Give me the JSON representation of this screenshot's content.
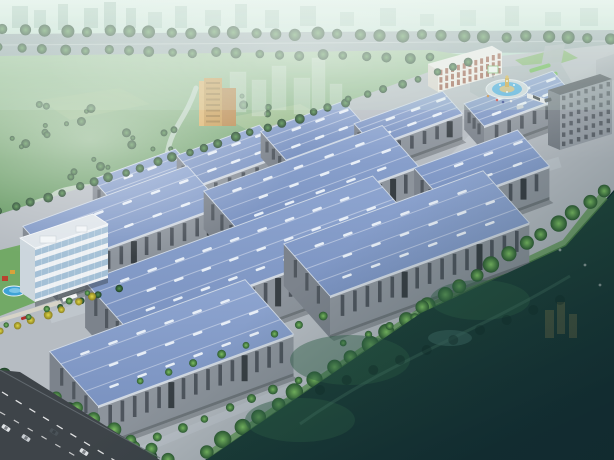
{
  "meta": {
    "alt": "aerial rendering of industrial park",
    "width": 614,
    "height": 460
  },
  "palette": {
    "sky_top": "#dcefe5",
    "sky_bottom": "#aed2c2",
    "city_block": "#7fa896",
    "road_top": "#93a2a6",
    "road_median": "#ccd6d8",
    "park_top": "#9ec39a",
    "park_bottom": "#649861",
    "field_patch1": "#a9c595",
    "field_patch2": "#9cbd8c",
    "lake": "#c3d4c6",
    "river": "#c2d6c8",
    "ground": "#b6bcc2",
    "inner_road": "#c2c8ce",
    "lawn_band": "#5d9a50",
    "roof_hi": "#8ea5d0",
    "roof_lo": "#7b93c1",
    "roof_edge": "#cfd9e6",
    "skylight": "#ecf2f9",
    "ridge": "rgba(255,255,255,0.38)",
    "wall_front": "#8d949c",
    "wall_side": "#7c838c",
    "wall_base": "#6b7278",
    "window_strip": "#454c54",
    "door": "#2f353b",
    "fascia": "#d8dee6",
    "shadow": "#30363c",
    "tree_dark_in": "#55924f",
    "tree_dark_out": "#1f4029",
    "tree_bright_in": "#7ec163",
    "tree_bright_out": "#2d5c33",
    "tree_yellow_in": "#e0d84a",
    "tree_yellow_out": "#8a7f1f",
    "office_frame": "#eef1f4",
    "office_glass": "#9fbdd4",
    "office_side": "#ccd6dd",
    "office_roof": "#dfe5ea",
    "red_bldg_face": "#f0ece6",
    "red_bldg_win": "#96513d",
    "red_bldg_side": "#d9d3cb",
    "red_bldg_roof": "#eceae6",
    "dorm_face": "#979ea6",
    "dorm_side": "#777e86",
    "dorm_roof": "#565c63",
    "dorm_win": "#4d545c",
    "tower_face": "#c79b52",
    "tower_side": "#dbb066",
    "tower_wing": "#b8874a",
    "ghost_bldg": "#dfe9e4",
    "plaza": "#aab3b8",
    "fountain_water": "#4fadde",
    "fountain_rim": "#ccd5da",
    "fountain_island": "#c9b878",
    "gold": "#c9a23b",
    "hedge1": "#6cb854",
    "hedge2": "#5da649",
    "entry_lawn": "#7ab061",
    "pool_water": "#3fa3d6",
    "pool_light": "#7cc6e8",
    "kiosk_red": "#b8432f",
    "kiosk_yellow": "#d8a23a",
    "garden_lawn": "#6aa65c",
    "path": "#d9d5c8",
    "red_car": "#b03028",
    "field_dark1": "#2a5a41",
    "field_dark2": "#132e33",
    "field_ghost": "#2f6247",
    "field_pond": "#3d6b62",
    "field_road": "#4e7f6b",
    "field_tower": "#caa95a",
    "sw_road": "#3e4449",
    "sw_road_edge": "#6a7278",
    "lane_dash": "#ffffff",
    "car_white": "#dfe3e6",
    "car_silver": "#c8cdd2",
    "car_dark": "#4a5258",
    "haze_white": "#ffffff",
    "haze_dark": "#10282c",
    "haze_tint": "#cfe8da"
  },
  "iso": {
    "u": [
      0.94,
      -0.345
    ],
    "v": [
      -0.55,
      -0.62
    ]
  },
  "skyline": {
    "band_h": 36,
    "blocks": [
      [
        12,
        6,
        16,
        22,
        0.5
      ],
      [
        34,
        10,
        12,
        18,
        0.45
      ],
      [
        58,
        4,
        10,
        26,
        0.5
      ],
      [
        84,
        8,
        14,
        20,
        0.5
      ],
      [
        104,
        2,
        12,
        28,
        0.55
      ],
      [
        126,
        8,
        10,
        20,
        0.5
      ],
      [
        148,
        12,
        14,
        16,
        0.4
      ],
      [
        175,
        6,
        12,
        22,
        0.45
      ],
      [
        205,
        10,
        16,
        16,
        0.4
      ],
      [
        235,
        4,
        12,
        24,
        0.45
      ],
      [
        265,
        10,
        14,
        18,
        0.4
      ],
      [
        300,
        6,
        16,
        20,
        0.4
      ],
      [
        340,
        12,
        14,
        14,
        0.35
      ],
      [
        380,
        8,
        16,
        18,
        0.35
      ],
      [
        420,
        14,
        14,
        12,
        0.3
      ],
      [
        460,
        10,
        16,
        16,
        0.3
      ],
      [
        505,
        6,
        14,
        20,
        0.32
      ],
      [
        545,
        12,
        16,
        14,
        0.3
      ],
      [
        580,
        8,
        18,
        18,
        0.32
      ]
    ]
  },
  "boulevard": {
    "road": [
      [
        0,
        34
      ],
      [
        614,
        30
      ],
      [
        614,
        52
      ],
      [
        0,
        56
      ]
    ],
    "median": {
      "a": [
        0,
        45
      ],
      "b": [
        614,
        41
      ]
    }
  },
  "park": {
    "base": [
      [
        0,
        56
      ],
      [
        430,
        50
      ],
      [
        470,
        56
      ],
      [
        340,
        108
      ],
      [
        0,
        214
      ]
    ],
    "fields": [
      {
        "pts": [
          [
            250,
            150
          ],
          [
            330,
            135
          ],
          [
            360,
            155
          ],
          [
            300,
            175
          ]
        ],
        "fill": "field_patch1",
        "o": 0.8
      },
      {
        "pts": [
          [
            150,
            190
          ],
          [
            230,
            175
          ],
          [
            262,
            196
          ],
          [
            190,
            215
          ]
        ],
        "fill": "field_patch2",
        "o": 0.8
      },
      {
        "pts": [
          [
            226,
            118
          ],
          [
            300,
            104
          ],
          [
            330,
            120
          ],
          [
            262,
            138
          ]
        ],
        "fill": "field_patch1",
        "o": 0.6
      },
      {
        "pts": [
          [
            40,
            100
          ],
          [
            120,
            88
          ],
          [
            150,
            104
          ],
          [
            70,
            120
          ]
        ],
        "fill": "field_patch2",
        "o": 0.5
      }
    ],
    "lake": [
      {
        "cx": 95,
        "cy": 197,
        "rx": 45,
        "ry": 13
      },
      {
        "cx": 150,
        "cy": 186,
        "rx": 30,
        "ry": 10
      },
      {
        "cx": 52,
        "cy": 206,
        "rx": 22,
        "ry": 9
      }
    ],
    "river_d": "M196,88 C186,118 172,128 168,150 C165,168 150,178 142,196",
    "clusters": [
      [
        65,
        115,
        7,
        26
      ],
      [
        150,
        140,
        7,
        24
      ],
      [
        250,
        105,
        5,
        20
      ],
      [
        215,
        170,
        6,
        24
      ],
      [
        90,
        168,
        5,
        20
      ],
      [
        300,
        150,
        4,
        16
      ],
      [
        30,
        140,
        5,
        18
      ]
    ],
    "ghosts": [
      [
        230,
        72,
        16,
        40
      ],
      [
        252,
        80,
        14,
        36
      ],
      [
        272,
        66,
        14,
        44
      ],
      [
        294,
        78,
        16,
        36
      ],
      [
        312,
        58,
        13,
        52
      ],
      [
        330,
        84,
        12,
        30
      ]
    ],
    "tower": {
      "front": [
        204,
        78,
        18,
        48
      ],
      "wing": [
        222,
        88,
        14,
        38
      ],
      "side_w": 5
    }
  },
  "site": {
    "ground": [
      [
        0,
        214
      ],
      [
        345,
        102
      ],
      [
        462,
        60
      ],
      [
        614,
        44
      ],
      [
        614,
        190
      ],
      [
        565,
        245
      ],
      [
        420,
        312
      ],
      [
        205,
        460
      ],
      [
        0,
        460
      ]
    ],
    "roads": [
      {
        "d": "M40,252 L470,112",
        "w": 9,
        "o": 0.8
      },
      {
        "d": "M50,318 L560,162",
        "w": 11,
        "o": 0.8
      },
      {
        "d": "M508,102 L330,290",
        "w": 11,
        "o": 0.75
      },
      {
        "d": "M112,462 L330,372",
        "w": 8,
        "o": 0.6
      }
    ],
    "lawn_d": "M604,196 L566,244 L422,312 L206,458"
  },
  "warehouses": [
    {
      "id": "s1",
      "p": [
        118,
        208
      ],
      "len": 88,
      "dep": 46,
      "wall": 26
    },
    {
      "id": "s2",
      "p": [
        202,
        184
      ],
      "len": 88,
      "dep": 46,
      "wall": 26
    },
    {
      "id": "s3",
      "p": [
        286,
        160
      ],
      "len": 88,
      "dep": 46,
      "wall": 26
    },
    {
      "id": "s4",
      "p": [
        374,
        146
      ],
      "len": 94,
      "dep": 36,
      "wall": 26
    },
    {
      "id": "s5",
      "p": [
        484,
        126
      ],
      "len": 94,
      "dep": 36,
      "wall": 26
    },
    {
      "id": "m1",
      "p": [
        58,
        266
      ],
      "len": 175,
      "dep": 64,
      "wall": 36
    },
    {
      "id": "m2",
      "p": [
        240,
        232
      ],
      "len": 190,
      "dep": 66,
      "wall": 38
    },
    {
      "id": "m3",
      "p": [
        446,
        204
      ],
      "len": 110,
      "dep": 58,
      "wall": 34
    },
    {
      "id": "f2",
      "p": [
        128,
        330
      ],
      "len": 306,
      "dep": 78,
      "wall": 46
    },
    {
      "id": "f3",
      "p": [
        330,
        296
      ],
      "len": 212,
      "dep": 84,
      "wall": 42
    },
    {
      "id": "f1",
      "p": [
        98,
        406
      ],
      "len": 208,
      "dep": 88,
      "wall": 42
    }
  ],
  "entry": {
    "plaza": [
      [
        470,
        70
      ],
      [
        560,
        62
      ],
      [
        580,
        96
      ],
      [
        505,
        112
      ],
      [
        470,
        92
      ]
    ],
    "access": [
      [
        545,
        46
      ],
      [
        565,
        44
      ],
      [
        560,
        70
      ],
      [
        540,
        72
      ]
    ],
    "red_building": {
      "front": [
        [
          438,
          70
        ],
        [
          502,
          52
        ],
        [
          502,
          74
        ],
        [
          438,
          92
        ]
      ],
      "side": [
        [
          428,
          64
        ],
        [
          438,
          70
        ],
        [
          438,
          92
        ],
        [
          428,
          86
        ]
      ],
      "roof": [
        [
          428,
          64
        ],
        [
          438,
          70
        ],
        [
          502,
          52
        ],
        [
          492,
          46
        ]
      ],
      "win_rows": 3,
      "win_cols": 11
    },
    "dorm": {
      "back_block": [
        [
          596,
          60
        ],
        [
          614,
          54
        ],
        [
          614,
          80
        ],
        [
          596,
          86
        ]
      ],
      "front": [
        [
          560,
          95
        ],
        [
          612,
          79
        ],
        [
          612,
          134
        ],
        [
          560,
          150
        ]
      ],
      "side": [
        [
          548,
          90
        ],
        [
          560,
          95
        ],
        [
          560,
          150
        ],
        [
          548,
          145
        ]
      ],
      "roof": [
        [
          548,
          90
        ],
        [
          560,
          95
        ],
        [
          612,
          79
        ],
        [
          600,
          74
        ]
      ],
      "win_rows": 6,
      "win_cols": 7
    },
    "gate": {
      "wall": [
        [
          527,
          93
        ],
        [
          546,
          99
        ],
        [
          546,
          104
        ],
        [
          527,
          98
        ]
      ],
      "bar": [
        [
          533,
          95
        ],
        [
          540,
          98
        ],
        [
          540,
          101
        ],
        [
          533,
          98
        ]
      ]
    },
    "billboard": {
      "x": 488,
      "y": 66,
      "w": 10,
      "h": 7
    },
    "hedges": [
      {
        "cx": 540,
        "cy": 68,
        "w": 22,
        "h": 4
      },
      {
        "cx": 548,
        "cy": 76,
        "w": 20,
        "h": 4
      }
    ],
    "lawn": [
      [
        515,
        60
      ],
      [
        560,
        48
      ],
      [
        578,
        58
      ],
      [
        532,
        72
      ]
    ],
    "fountain": {
      "cx": 507,
      "cy": 89,
      "rx_plaza": 21,
      "ry_plaza": 9.5,
      "rx_water": 15,
      "ry_water": 7,
      "rx_island": 7.5,
      "ry_island": 3.5,
      "jets": [
        [
          500,
          85
        ],
        [
          514,
          85
        ],
        [
          507,
          81
        ],
        [
          507,
          92
        ]
      ]
    },
    "people": [
      [
        497,
        100,
        "#c23434"
      ],
      [
        503,
        102,
        "#2b3a8c"
      ],
      [
        511,
        101,
        "#e8e8e8"
      ],
      [
        488,
        96,
        "#c87f2a"
      ]
    ],
    "cars": [
      [
        520,
        107,
        -15,
        "car_silver"
      ],
      [
        548,
        100,
        -15,
        "car_dark"
      ]
    ]
  },
  "office": {
    "front": [
      [
        35,
        302
      ],
      [
        108,
        278
      ],
      [
        108,
        224
      ],
      [
        35,
        248
      ]
    ],
    "side": [
      [
        20,
        292
      ],
      [
        35,
        302
      ],
      [
        35,
        248
      ],
      [
        20,
        238
      ]
    ],
    "roof": [
      [
        20,
        238
      ],
      [
        35,
        248
      ],
      [
        108,
        224
      ],
      [
        93,
        214
      ]
    ],
    "floors": 5,
    "boxes": [
      [
        40,
        236,
        16,
        7
      ],
      [
        76,
        226,
        11,
        6
      ]
    ],
    "canopy": [
      [
        62,
        298,
        15,
        4
      ]
    ],
    "shadow": [
      [
        35,
        302
      ],
      [
        108,
        278
      ],
      [
        108,
        283
      ],
      [
        35,
        307
      ]
    ]
  },
  "garden": {
    "lawn": [
      [
        0,
        250
      ],
      [
        32,
        242
      ],
      [
        62,
        292
      ],
      [
        0,
        316
      ]
    ],
    "path": [
      [
        0,
        318
      ],
      [
        60,
        300
      ],
      [
        62,
        304
      ],
      [
        0,
        322
      ]
    ],
    "pool": {
      "cx": 14,
      "cy": 291,
      "rx": 11,
      "ry": 5
    },
    "kiosks": [
      {
        "x": 2,
        "y": 276,
        "w": 6,
        "h": 5,
        "fill": "kiosk_red"
      },
      {
        "x": 10,
        "y": 270,
        "w": 5,
        "h": 4,
        "fill": "kiosk_yellow"
      }
    ],
    "car": {
      "x": 24,
      "y": 318,
      "rot": -18
    }
  },
  "tree_rows": [
    {
      "a": [
        4,
        30
      ],
      "b": [
        610,
        38
      ],
      "n": 30,
      "r": 6,
      "g": "t1"
    },
    {
      "a": [
        0,
        48
      ],
      "b": [
        430,
        58
      ],
      "n": 21,
      "r": 5,
      "g": "t1"
    },
    {
      "a": [
        0,
        212
      ],
      "b": [
        345,
        103
      ],
      "n": 23,
      "r": 4.5,
      "g": "t1"
    },
    {
      "a": [
        350,
        100
      ],
      "b": [
        470,
        62
      ],
      "n": 8,
      "r": 4,
      "g": "t1"
    },
    {
      "a": [
        606,
        192
      ],
      "b": [
        428,
        306
      ],
      "n": 12,
      "r": 7.5,
      "g": "t2"
    },
    {
      "a": [
        424,
        308
      ],
      "b": [
        205,
        452
      ],
      "n": 13,
      "r": 8,
      "g": "t2"
    },
    {
      "a": [
        6,
        376
      ],
      "b": [
        150,
        458
      ],
      "n": 8,
      "r": 8.5,
      "g": "t1"
    },
    {
      "a": [
        58,
        398
      ],
      "b": [
        168,
        460
      ],
      "n": 7,
      "r": 6.5,
      "g": "t2"
    },
    {
      "a": [
        112,
        456
      ],
      "b": [
        298,
        380
      ],
      "n": 9,
      "r": 4.5,
      "g": "t2"
    },
    {
      "a": [
        345,
        344
      ],
      "b": [
        528,
        272
      ],
      "n": 9,
      "r": 4,
      "g": "t2"
    },
    {
      "a": [
        142,
        382
      ],
      "b": [
        325,
        316
      ],
      "n": 8,
      "r": 4,
      "g": "t2"
    },
    {
      "a": [
        62,
        308
      ],
      "b": [
        118,
        288
      ],
      "n": 4,
      "r": 3.5,
      "g": "t1"
    },
    {
      "a": [
        2,
        332
      ],
      "b": [
        92,
        297
      ],
      "n": 7,
      "r": 4,
      "g": "ty"
    },
    {
      "a": [
        8,
        326
      ],
      "b": [
        88,
        292
      ],
      "n": 5,
      "r": 3.2,
      "g": "t2"
    }
  ],
  "field": {
    "poly": [
      [
        614,
        192
      ],
      [
        566,
        246
      ],
      [
        421,
        313
      ],
      [
        206,
        460
      ],
      [
        614,
        460
      ]
    ],
    "ghost_blobs": [
      {
        "cx": 350,
        "cy": 360,
        "rx": 60,
        "ry": 25
      },
      {
        "cx": 480,
        "cy": 300,
        "rx": 50,
        "ry": 20
      },
      {
        "cx": 300,
        "cy": 420,
        "rx": 55,
        "ry": 22
      }
    ],
    "pond": {
      "cx": 450,
      "cy": 338,
      "rx": 22,
      "ry": 8
    },
    "road_d": "M300,424 C390,360 470,336 570,276",
    "towers": [
      [
        545,
        310,
        9,
        28
      ],
      [
        557,
        302,
        8,
        32
      ],
      [
        569,
        314,
        8,
        24
      ]
    ],
    "tree_line": {
      "a": [
        320,
        390
      ],
      "b": [
        560,
        300
      ],
      "n": 10,
      "r": 5
    },
    "specks": [
      [
        585,
        265
      ],
      [
        600,
        285
      ],
      [
        560,
        250
      ]
    ]
  },
  "sw_road": {
    "poly": [
      [
        0,
        370
      ],
      [
        20,
        372
      ],
      [
        160,
        460
      ],
      [
        0,
        460
      ]
    ],
    "dashes": [
      {
        "d": "M2,392 L150,482",
        "w": 1.3,
        "da": "7 9",
        "o": 0.85
      },
      {
        "d": "M0,412 L120,482",
        "w": 1.2,
        "da": "6 10",
        "o": 0.7
      }
    ],
    "cars": [
      [
        6,
        428,
        33,
        "car_white"
      ],
      [
        26,
        438,
        33,
        "car_silver"
      ],
      [
        54,
        432,
        33,
        "car_dark"
      ],
      [
        84,
        452,
        33,
        "car_white"
      ]
    ]
  }
}
